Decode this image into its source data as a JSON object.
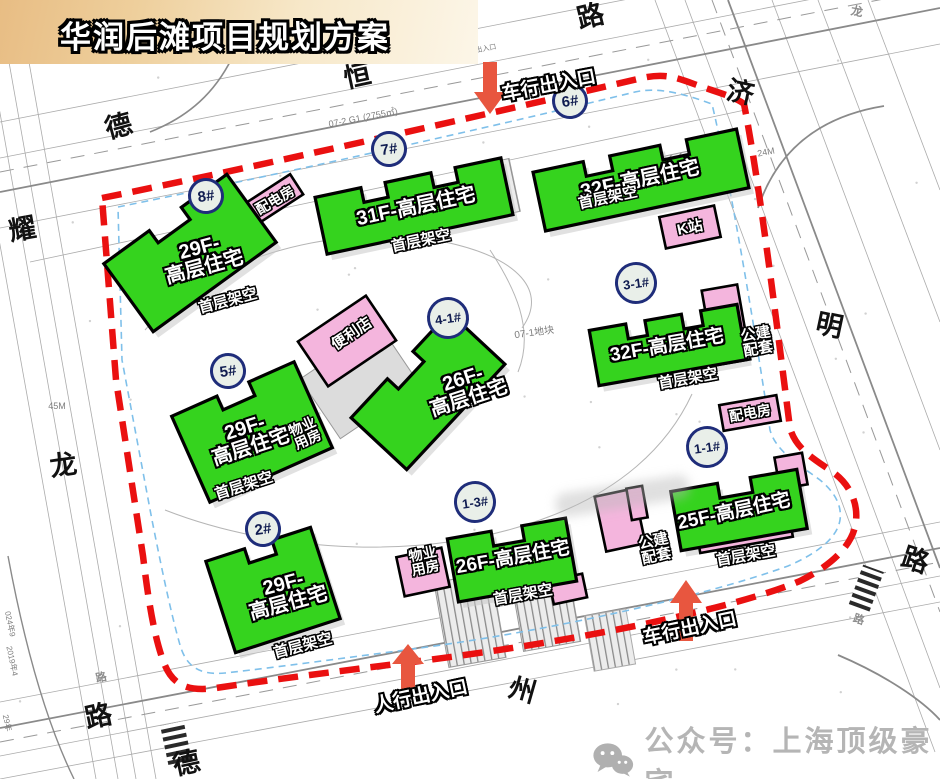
{
  "title": "华润后滩项目规划方案",
  "footer": {
    "text": "公众号：上海顶级豪宅"
  },
  "colors": {
    "building_green": "#35d31e",
    "aux_pink": "#f4b5dd",
    "boundary_red": "#ea1010",
    "setback_blue": "#7fc0ea",
    "arrow_red": "#e8563f",
    "circle_border": "#1f2d7a",
    "banner_tan": "#e8bd84"
  },
  "buildings": [
    {
      "id": "8",
      "label_lines": [
        "29F-",
        "高层住宅"
      ],
      "note": "首层架空",
      "geom": {
        "x": 190,
        "y": 253,
        "w": 152,
        "h": 84,
        "rot": -36,
        "teeth": 2
      },
      "label_pos": {
        "x": 202,
        "y": 258,
        "rot": -15,
        "fs": 20
      },
      "note_pos": {
        "x": 228,
        "y": 301,
        "rot": -15
      }
    },
    {
      "id": "7",
      "label_lines": [
        "31F-高层住宅"
      ],
      "note": "首层架空",
      "geom": {
        "x": 414,
        "y": 206,
        "w": 190,
        "h": 58,
        "rot": -12,
        "teeth": 3
      },
      "label_pos": {
        "x": 416,
        "y": 207,
        "rot": -12,
        "fs": 20
      },
      "note_pos": {
        "x": 421,
        "y": 241,
        "rot": -12
      }
    },
    {
      "id": "6",
      "label_lines": [
        "32F-高层住宅"
      ],
      "note": "首层架空",
      "geom": {
        "x": 641,
        "y": 180,
        "w": 208,
        "h": 60,
        "rot": -12,
        "teeth": 3
      },
      "label_pos": {
        "x": 640,
        "y": 180,
        "rot": -12,
        "fs": 20
      },
      "note_pos": {
        "x": 608,
        "y": 198,
        "rot": -12
      }
    },
    {
      "id": "3-1",
      "label_lines": [
        "32F-高层住宅"
      ],
      "note": "首层架空",
      "geom": {
        "x": 668,
        "y": 345,
        "w": 150,
        "h": 56,
        "rot": -10,
        "teeth": 3
      },
      "label_pos": {
        "x": 667,
        "y": 346,
        "rot": -10,
        "fs": 19
      },
      "note_pos": {
        "x": 688,
        "y": 379,
        "rot": -10
      }
    },
    {
      "id": "4-1",
      "label_lines": [
        "26F-",
        "高层住宅"
      ],
      "note": null,
      "geom": {
        "x": 428,
        "y": 391,
        "w": 144,
        "h": 76,
        "rot": -47,
        "teeth": 2
      },
      "label_pos": {
        "x": 466,
        "y": 389,
        "rot": -18,
        "fs": 20
      },
      "note_pos": null
    },
    {
      "id": "5",
      "label_lines": [
        "29F-",
        "高层住宅"
      ],
      "note": "首层架空",
      "geom": {
        "x": 252,
        "y": 432,
        "w": 134,
        "h": 94,
        "rot": -24,
        "teeth": 2
      },
      "label_pos": {
        "x": 248,
        "y": 438,
        "rot": -18,
        "fs": 20
      },
      "note_pos": {
        "x": 244,
        "y": 486,
        "rot": -18
      }
    },
    {
      "id": "2",
      "label_lines": [
        "29F-",
        "高层住宅"
      ],
      "note": "首层架空",
      "geom": {
        "x": 273,
        "y": 590,
        "w": 110,
        "h": 96,
        "rot": -18,
        "teeth": 2
      },
      "label_pos": {
        "x": 286,
        "y": 594,
        "rot": -15,
        "fs": 20
      },
      "note_pos": {
        "x": 303,
        "y": 646,
        "rot": -15
      }
    },
    {
      "id": "1-3",
      "label_lines": [
        "26F-高层住宅"
      ],
      "note": "首层架空",
      "geom": {
        "x": 512,
        "y": 560,
        "w": 120,
        "h": 64,
        "rot": -10,
        "teeth": 2
      },
      "label_pos": {
        "x": 513,
        "y": 558,
        "rot": -10,
        "fs": 19
      },
      "note_pos": {
        "x": 523,
        "y": 595,
        "rot": -10
      }
    },
    {
      "id": "1-1",
      "label_lines": [
        "25F-高层住宅"
      ],
      "note": "首层架空",
      "geom": {
        "x": 739,
        "y": 510,
        "w": 128,
        "h": 60,
        "rot": -10,
        "teeth": 2
      },
      "label_pos": {
        "x": 734,
        "y": 512,
        "rot": -12,
        "fs": 19
      },
      "note_pos": {
        "x": 746,
        "y": 556,
        "rot": -10
      }
    }
  ],
  "aux_buildings": [
    {
      "key": "peidianfang-top",
      "label_lines": [
        "配电房"
      ],
      "rects": [
        {
          "x": 274,
          "y": 199,
          "w": 54,
          "h": 24,
          "rot": -33
        }
      ],
      "label_pos": {
        "x": 275,
        "y": 200,
        "rot": -30,
        "fs": 14
      }
    },
    {
      "key": "k-zhan",
      "label_lines": [
        "K站"
      ],
      "rects": [
        {
          "x": 690,
          "y": 227,
          "w": 56,
          "h": 32,
          "rot": -12
        }
      ],
      "label_pos": {
        "x": 690,
        "y": 228,
        "rot": -12,
        "fs": 15
      }
    },
    {
      "key": "bianlidian",
      "label_lines": [
        "便利店"
      ],
      "rects": [
        {
          "x": 347,
          "y": 341,
          "w": 82,
          "h": 54,
          "rot": -34
        }
      ],
      "label_pos": {
        "x": 352,
        "y": 334,
        "rot": -34,
        "fs": 15
      }
    },
    {
      "key": "wuye-yongfang-5",
      "label_lines": [
        "物业",
        "用房"
      ],
      "rects": [
        {
          "x": 272,
          "y": 425,
          "w": 38,
          "h": 28,
          "rot": -24
        }
      ],
      "label_pos": {
        "x": 305,
        "y": 433,
        "rot": -24,
        "fs": 14
      }
    },
    {
      "key": "gongjian-peitao-31",
      "label_lines": [
        "公建",
        "配套"
      ],
      "rects": [
        {
          "x": 726,
          "y": 325,
          "w": 36,
          "h": 76,
          "rot": -10
        }
      ],
      "label_pos": {
        "x": 757,
        "y": 342,
        "rot": -10,
        "fs": 15
      }
    },
    {
      "key": "peidianfang-right",
      "label_lines": [
        "配电房"
      ],
      "rects": [
        {
          "x": 750,
          "y": 413,
          "w": 58,
          "h": 26,
          "rot": -10
        }
      ],
      "label_pos": {
        "x": 750,
        "y": 413,
        "rot": -10,
        "fs": 14
      }
    },
    {
      "key": "wuye-yongfang-btm",
      "label_lines": [
        "物业",
        "用房"
      ],
      "rects": [
        {
          "x": 423,
          "y": 572,
          "w": 46,
          "h": 40,
          "rot": -12
        }
      ],
      "label_pos": {
        "x": 424,
        "y": 561,
        "rot": -12,
        "fs": 14
      }
    },
    {
      "key": "gongjian-peitao-btm",
      "label_lines": [
        "公建",
        "配套"
      ],
      "rects": [
        {
          "x": 620,
          "y": 520,
          "w": 40,
          "h": 56,
          "rot": -12
        },
        {
          "x": 568,
          "y": 589,
          "w": 34,
          "h": 24,
          "rot": -12
        },
        {
          "x": 637,
          "y": 503,
          "w": 16,
          "h": 32,
          "rot": -10
        }
      ],
      "label_pos": {
        "x": 655,
        "y": 549,
        "rot": -12,
        "fs": 15
      }
    },
    {
      "key": "gongjian-strip-11",
      "label_lines": [],
      "rects": [
        {
          "x": 745,
          "y": 536,
          "w": 94,
          "h": 18,
          "rot": -10
        },
        {
          "x": 791,
          "y": 471,
          "w": 28,
          "h": 32,
          "rot": -10
        }
      ],
      "label_pos": null
    }
  ],
  "unit_circles": [
    {
      "text": "8#",
      "x": 224,
      "y": 214,
      "d": 36
    },
    {
      "text": "7#",
      "x": 407,
      "y": 167,
      "d": 36
    },
    {
      "text": "6#",
      "x": 588,
      "y": 119,
      "d": 36
    },
    {
      "text": "3-1#",
      "x": 657,
      "y": 304,
      "d": 42
    },
    {
      "text": "4-1#",
      "x": 469,
      "y": 339,
      "d": 42
    },
    {
      "text": "5#",
      "x": 246,
      "y": 389,
      "d": 36
    },
    {
      "text": "2#",
      "x": 281,
      "y": 547,
      "d": 36
    },
    {
      "text": "1-3#",
      "x": 496,
      "y": 523,
      "d": 42
    },
    {
      "text": "1-1#",
      "x": 728,
      "y": 468,
      "d": 42
    }
  ],
  "arrows": [
    {
      "label": "车行出入口",
      "dir": "down",
      "x": 490,
      "tail": 62,
      "neck": 92,
      "tip": 114,
      "label_pos": {
        "x": 549,
        "y": 86,
        "rot": -11
      }
    },
    {
      "label": "人行出入口",
      "dir": "up",
      "x": 408,
      "tail": 690,
      "neck": 664,
      "tip": 644,
      "label_pos": {
        "x": 421,
        "y": 697,
        "rot": -12
      }
    },
    {
      "label": "车行出入口",
      "dir": "up",
      "x": 686,
      "tail": 641,
      "neck": 603,
      "tip": 580,
      "label_pos": {
        "x": 690,
        "y": 629,
        "rot": -12
      }
    }
  ],
  "road_names": [
    {
      "t": "路",
      "x": 590,
      "y": 14,
      "rot": -14
    },
    {
      "t": "恒",
      "x": 357,
      "y": 74,
      "rot": -12
    },
    {
      "t": "德",
      "x": 118,
      "y": 124,
      "rot": -15
    },
    {
      "t": "耀",
      "x": 22,
      "y": 227,
      "rot": -10
    },
    {
      "t": "龙",
      "x": 63,
      "y": 463,
      "rot": -8
    },
    {
      "t": "济",
      "x": 741,
      "y": 90,
      "rot": 12
    },
    {
      "t": "明",
      "x": 830,
      "y": 323,
      "rot": 12
    },
    {
      "t": "路",
      "x": 916,
      "y": 558,
      "rot": 18
    },
    {
      "t": "州",
      "x": 523,
      "y": 688,
      "rot": 16
    },
    {
      "t": "路",
      "x": 98,
      "y": 714,
      "rot": -12
    },
    {
      "t": "德",
      "x": 186,
      "y": 761,
      "rot": -12
    }
  ],
  "gray_road_names": [
    {
      "t": "龙",
      "x": 857,
      "y": 11,
      "fs": 12,
      "rot": 10
    },
    {
      "t": "路",
      "x": 18,
      "y": 48,
      "fs": 11,
      "rot": -10
    },
    {
      "t": "路",
      "x": 101,
      "y": 677,
      "fs": 11,
      "rot": -12
    },
    {
      "t": "路",
      "x": 859,
      "y": 619,
      "fs": 11,
      "rot": 18
    }
  ],
  "plan_labels": [
    {
      "t": "07-2 G1 (2755㎡)",
      "x": 363,
      "y": 117,
      "fs": 9,
      "rot": -11
    },
    {
      "t": "07-1地块",
      "x": 534,
      "y": 331,
      "fs": 10,
      "rot": -8
    },
    {
      "t": "20M",
      "x": 413,
      "y": 51,
      "fs": 9,
      "rot": 78
    },
    {
      "t": "24M",
      "x": 766,
      "y": 152,
      "fs": 9,
      "rot": -11
    },
    {
      "t": "45M",
      "x": 57,
      "y": 406,
      "fs": 9,
      "rot": 0
    },
    {
      "t": "车行出入口",
      "x": 479,
      "y": 50,
      "fs": 7,
      "rot": -11
    },
    {
      "t": "024年9",
      "x": 10,
      "y": 624,
      "fs": 8,
      "rot": 78
    },
    {
      "t": "2019年4",
      "x": 12,
      "y": 661,
      "fs": 8,
      "rot": 78
    },
    {
      "t": "29年",
      "x": 7,
      "y": 723,
      "fs": 8,
      "rot": 78
    }
  ]
}
